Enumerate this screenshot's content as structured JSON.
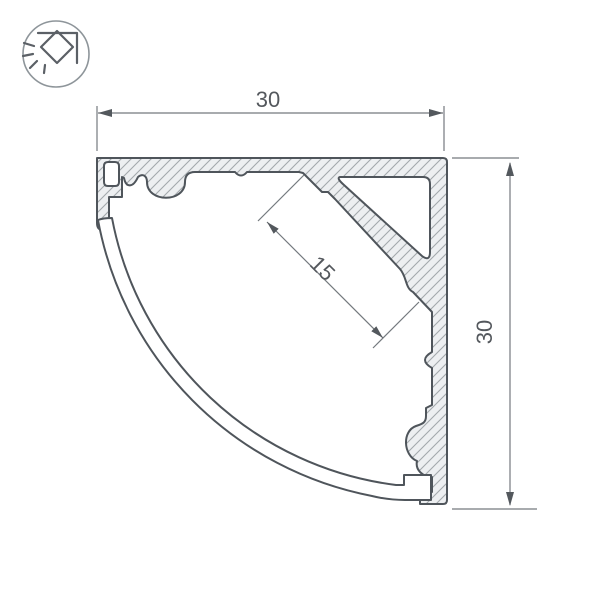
{
  "drawing": {
    "type": "aluminum-corner-profile-cross-section",
    "dimension_labels": {
      "top_width": "30",
      "right_height": "30",
      "shelf_width": "15"
    },
    "logo": {
      "icon": "corner-mounted-light"
    },
    "colors": {
      "outline": "#4f555b",
      "hatch_line": "#a3a9ad",
      "metal_fill": "#edeff1",
      "dimension_line": "#74797e",
      "text": "#54585d",
      "logo_ring": "#8e959a"
    }
  }
}
